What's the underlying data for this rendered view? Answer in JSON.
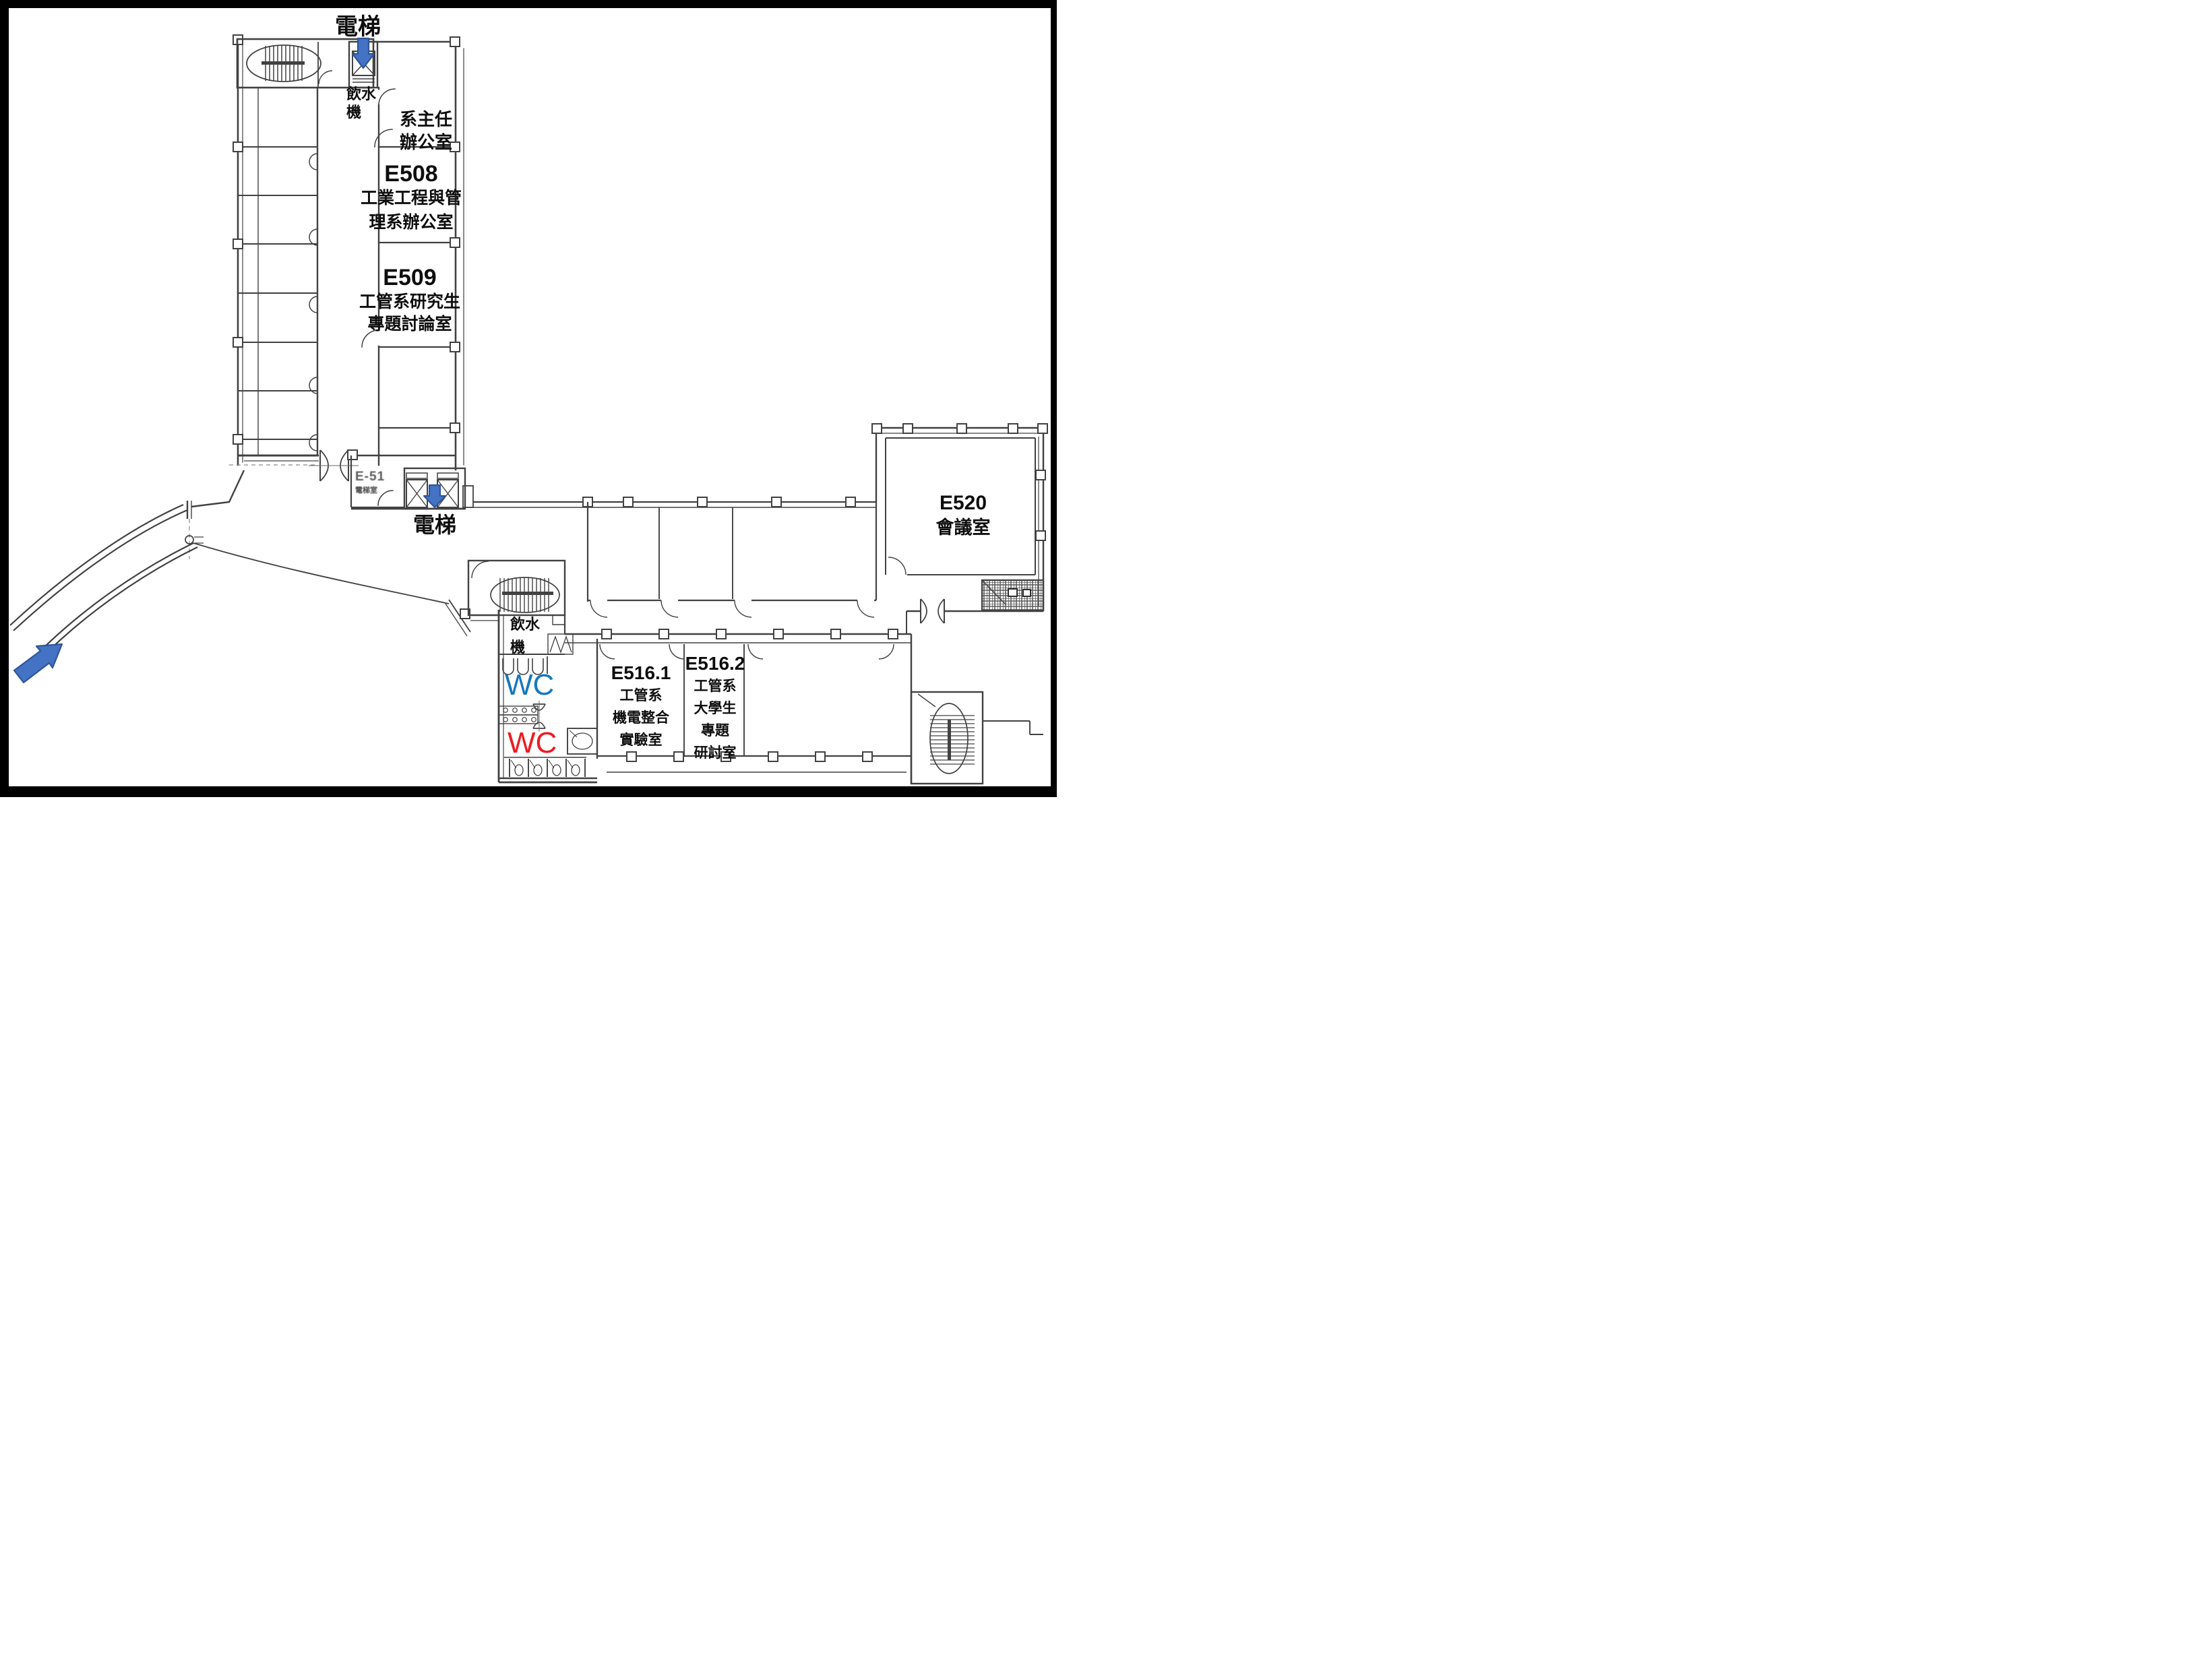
{
  "rooms": {
    "dept_head_office": {
      "lines": [
        "系主任",
        "辦公室"
      ]
    },
    "e508": {
      "code": "E508",
      "lines": [
        "工業工程與管",
        "理系辦公室"
      ]
    },
    "e509": {
      "code": "E509",
      "lines": [
        "工管系研究生",
        "專題討論室"
      ]
    },
    "e51x": {
      "code": "E-51",
      "sub": "電梯室"
    },
    "e520": {
      "code": "E520",
      "lines": [
        "會議室"
      ]
    },
    "e516_1": {
      "code": "E516.1",
      "lines": [
        "工管系",
        "機電整合",
        "實驗室"
      ]
    },
    "e516_2": {
      "code": "E516.2",
      "lines": [
        "工管系",
        "大學生",
        "專題",
        "研討室"
      ]
    }
  },
  "facilities": {
    "elevator_top": "電梯",
    "elevator_mid": "電梯",
    "water_fountain_top": {
      "lines": [
        "飲水",
        "機"
      ]
    },
    "water_fountain_bottom": {
      "lines": [
        "飲水",
        "機"
      ]
    },
    "wc_blue": "WC",
    "wc_red": "WC"
  },
  "colors": {
    "annotation_arrow": "#4472c4",
    "annotation_arrow_border": "#2e5597",
    "wc_blue": "#1878be",
    "wc_red": "#ed1c24",
    "plan_line": "#414141"
  }
}
